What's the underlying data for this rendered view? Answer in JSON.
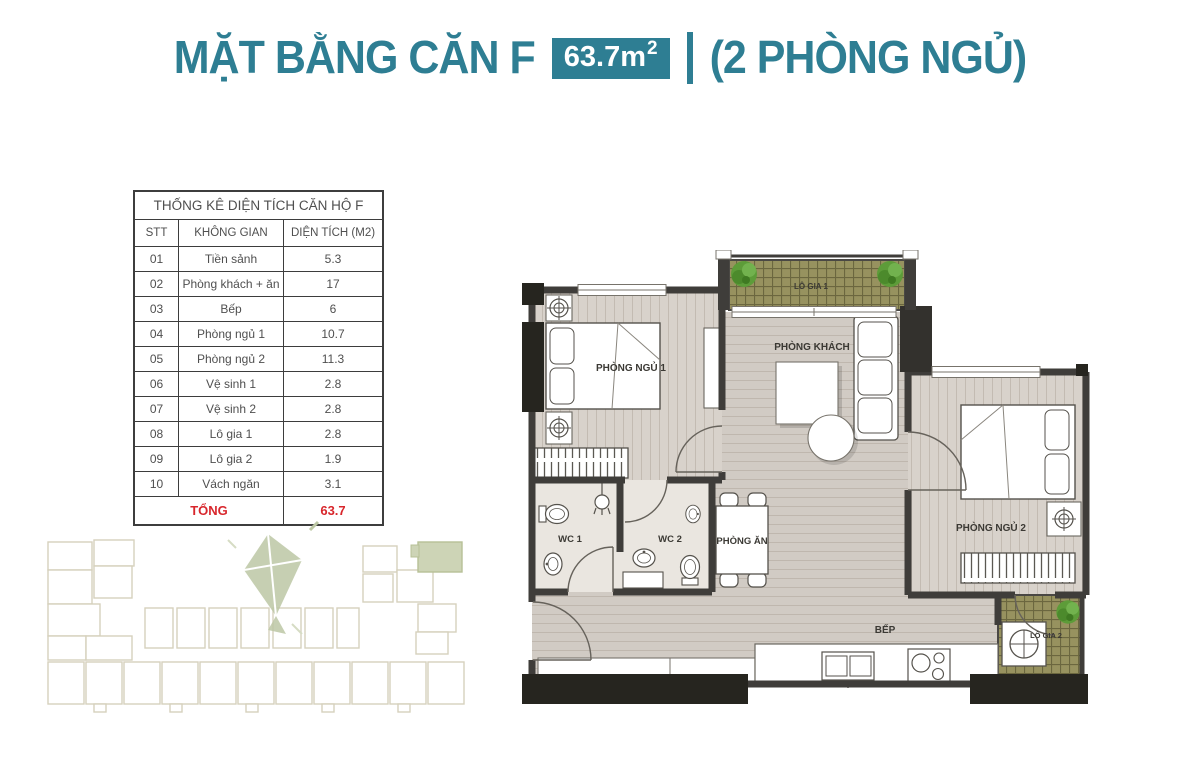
{
  "header": {
    "title": "MẶT BẰNG CĂN F",
    "area_value": "63.7m",
    "area_superscript": "2",
    "divider": "|",
    "subtitle": "(2 PHÒNG NGỦ)",
    "accent_color": "#2e7e93"
  },
  "stats_table": {
    "title": "THỐNG KÊ DIỆN TÍCH CĂN HỘ F",
    "columns": [
      "STT",
      "KHÔNG GIAN",
      "DIỆN TÍCH (M2)"
    ],
    "rows": [
      {
        "stt": "01",
        "space": "Tiền sảnh",
        "area": "5.3"
      },
      {
        "stt": "02",
        "space": "Phòng khách + ăn",
        "area": "17"
      },
      {
        "stt": "03",
        "space": "Bếp",
        "area": "6"
      },
      {
        "stt": "04",
        "space": "Phòng ngủ 1",
        "area": "10.7"
      },
      {
        "stt": "05",
        "space": "Phòng ngủ 2",
        "area": "11.3"
      },
      {
        "stt": "06",
        "space": "Vệ sinh 1",
        "area": "2.8"
      },
      {
        "stt": "07",
        "space": "Vệ sinh 2",
        "area": "2.8"
      },
      {
        "stt": "08",
        "space": "Lô gia 1",
        "area": "2.8"
      },
      {
        "stt": "09",
        "space": "Lô gia 2",
        "area": "1.9"
      },
      {
        "stt": "10",
        "space": "Vách ngăn",
        "area": "3.1"
      }
    ],
    "total_label": "TỔNG",
    "total_value": "63.7",
    "total_color": "#d8262c"
  },
  "floorplan": {
    "rooms": {
      "bedroom1": "PHÒNG NGỦ 1",
      "living_room": "PHÒNG KHÁCH",
      "bedroom2": "PHÒNG NGỦ 2",
      "wc1": "WC 1",
      "wc2": "WC 2",
      "dining": "PHÒNG ĂN",
      "kitchen": "BẾP",
      "loggia1": "LÔ GIA 1",
      "loggia2": "LÔ GIA 2"
    },
    "colors": {
      "wall": "#3f3d3a",
      "wood_floor": "#d8d2cb",
      "open_floor": "#d1cbc4",
      "wc_floor": "#eae6e0",
      "balcony": "#97925f",
      "plant": "#5d9c39"
    }
  }
}
